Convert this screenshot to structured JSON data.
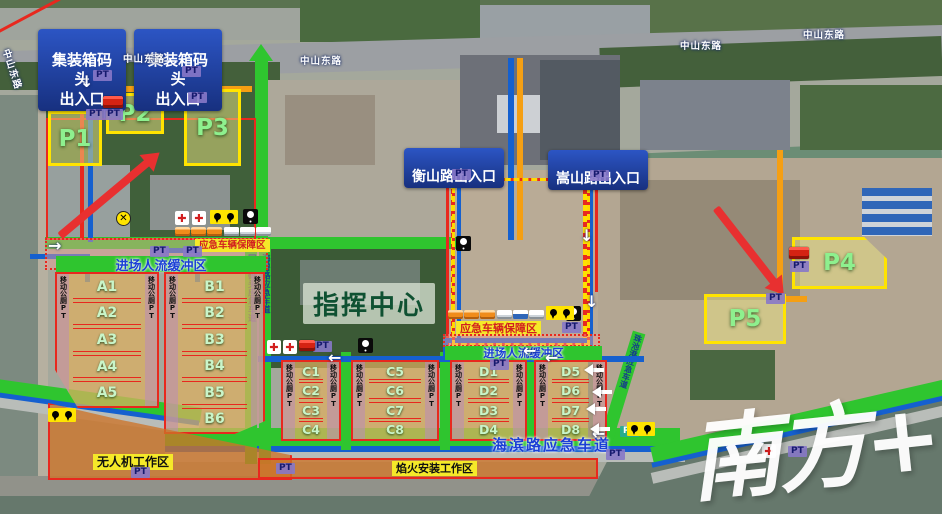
{
  "labels": {
    "container_exit": "集装箱码头\n出入口",
    "hengshan_exit": "衡山路出入口",
    "songshan_exit": "嵩山路出入口",
    "command_center": "指挥中心",
    "buffer_zone": "进场人流缓冲区",
    "vehicle_support_zone": "应急车辆保障区",
    "drone_area": "无人机工作区",
    "fireworks_area": "焰火安装工作区",
    "haibin_lane": "海滨路应急车道",
    "guoji_lane": "国集码头应急车道",
    "haibi_lane": "海碧路应急车道",
    "zhuchi_lane": "珠池港应急车道",
    "mobile_toilet": "移动公厕PT",
    "pt": "PT",
    "road": "中山东路",
    "watermark": "南方+"
  },
  "parking_zones": [
    "P1",
    "P2",
    "P3",
    "P4",
    "P5"
  ],
  "grids": {
    "A": [
      "A1",
      "A2",
      "A3",
      "A4",
      "A5"
    ],
    "B": [
      "B1",
      "B2",
      "B3",
      "B4",
      "B5",
      "B6"
    ],
    "C_left": [
      "C1",
      "C2",
      "C3",
      "C4"
    ],
    "C_right": [
      "C5",
      "C6",
      "C7",
      "C8"
    ],
    "D_left": [
      "D1",
      "D2",
      "D3",
      "D4"
    ],
    "D_right": [
      "D5",
      "D6",
      "D7",
      "D8"
    ]
  },
  "icons": {
    "medical_cross": "✚",
    "x_marker": "✕",
    "location_pin": "pin",
    "light": "bulb",
    "bus": "bus",
    "fire_truck": "fire-truck",
    "ambulance": "ambulance"
  },
  "colors": {
    "route_green": "#2fc52f",
    "route_blue": "#1560cf",
    "route_red": "#e8281e",
    "route_orange": "#f59f13",
    "zone_yellow": "#ffe400",
    "label_bg_blue": "#17307f",
    "pt_purple": "#9183c9"
  }
}
